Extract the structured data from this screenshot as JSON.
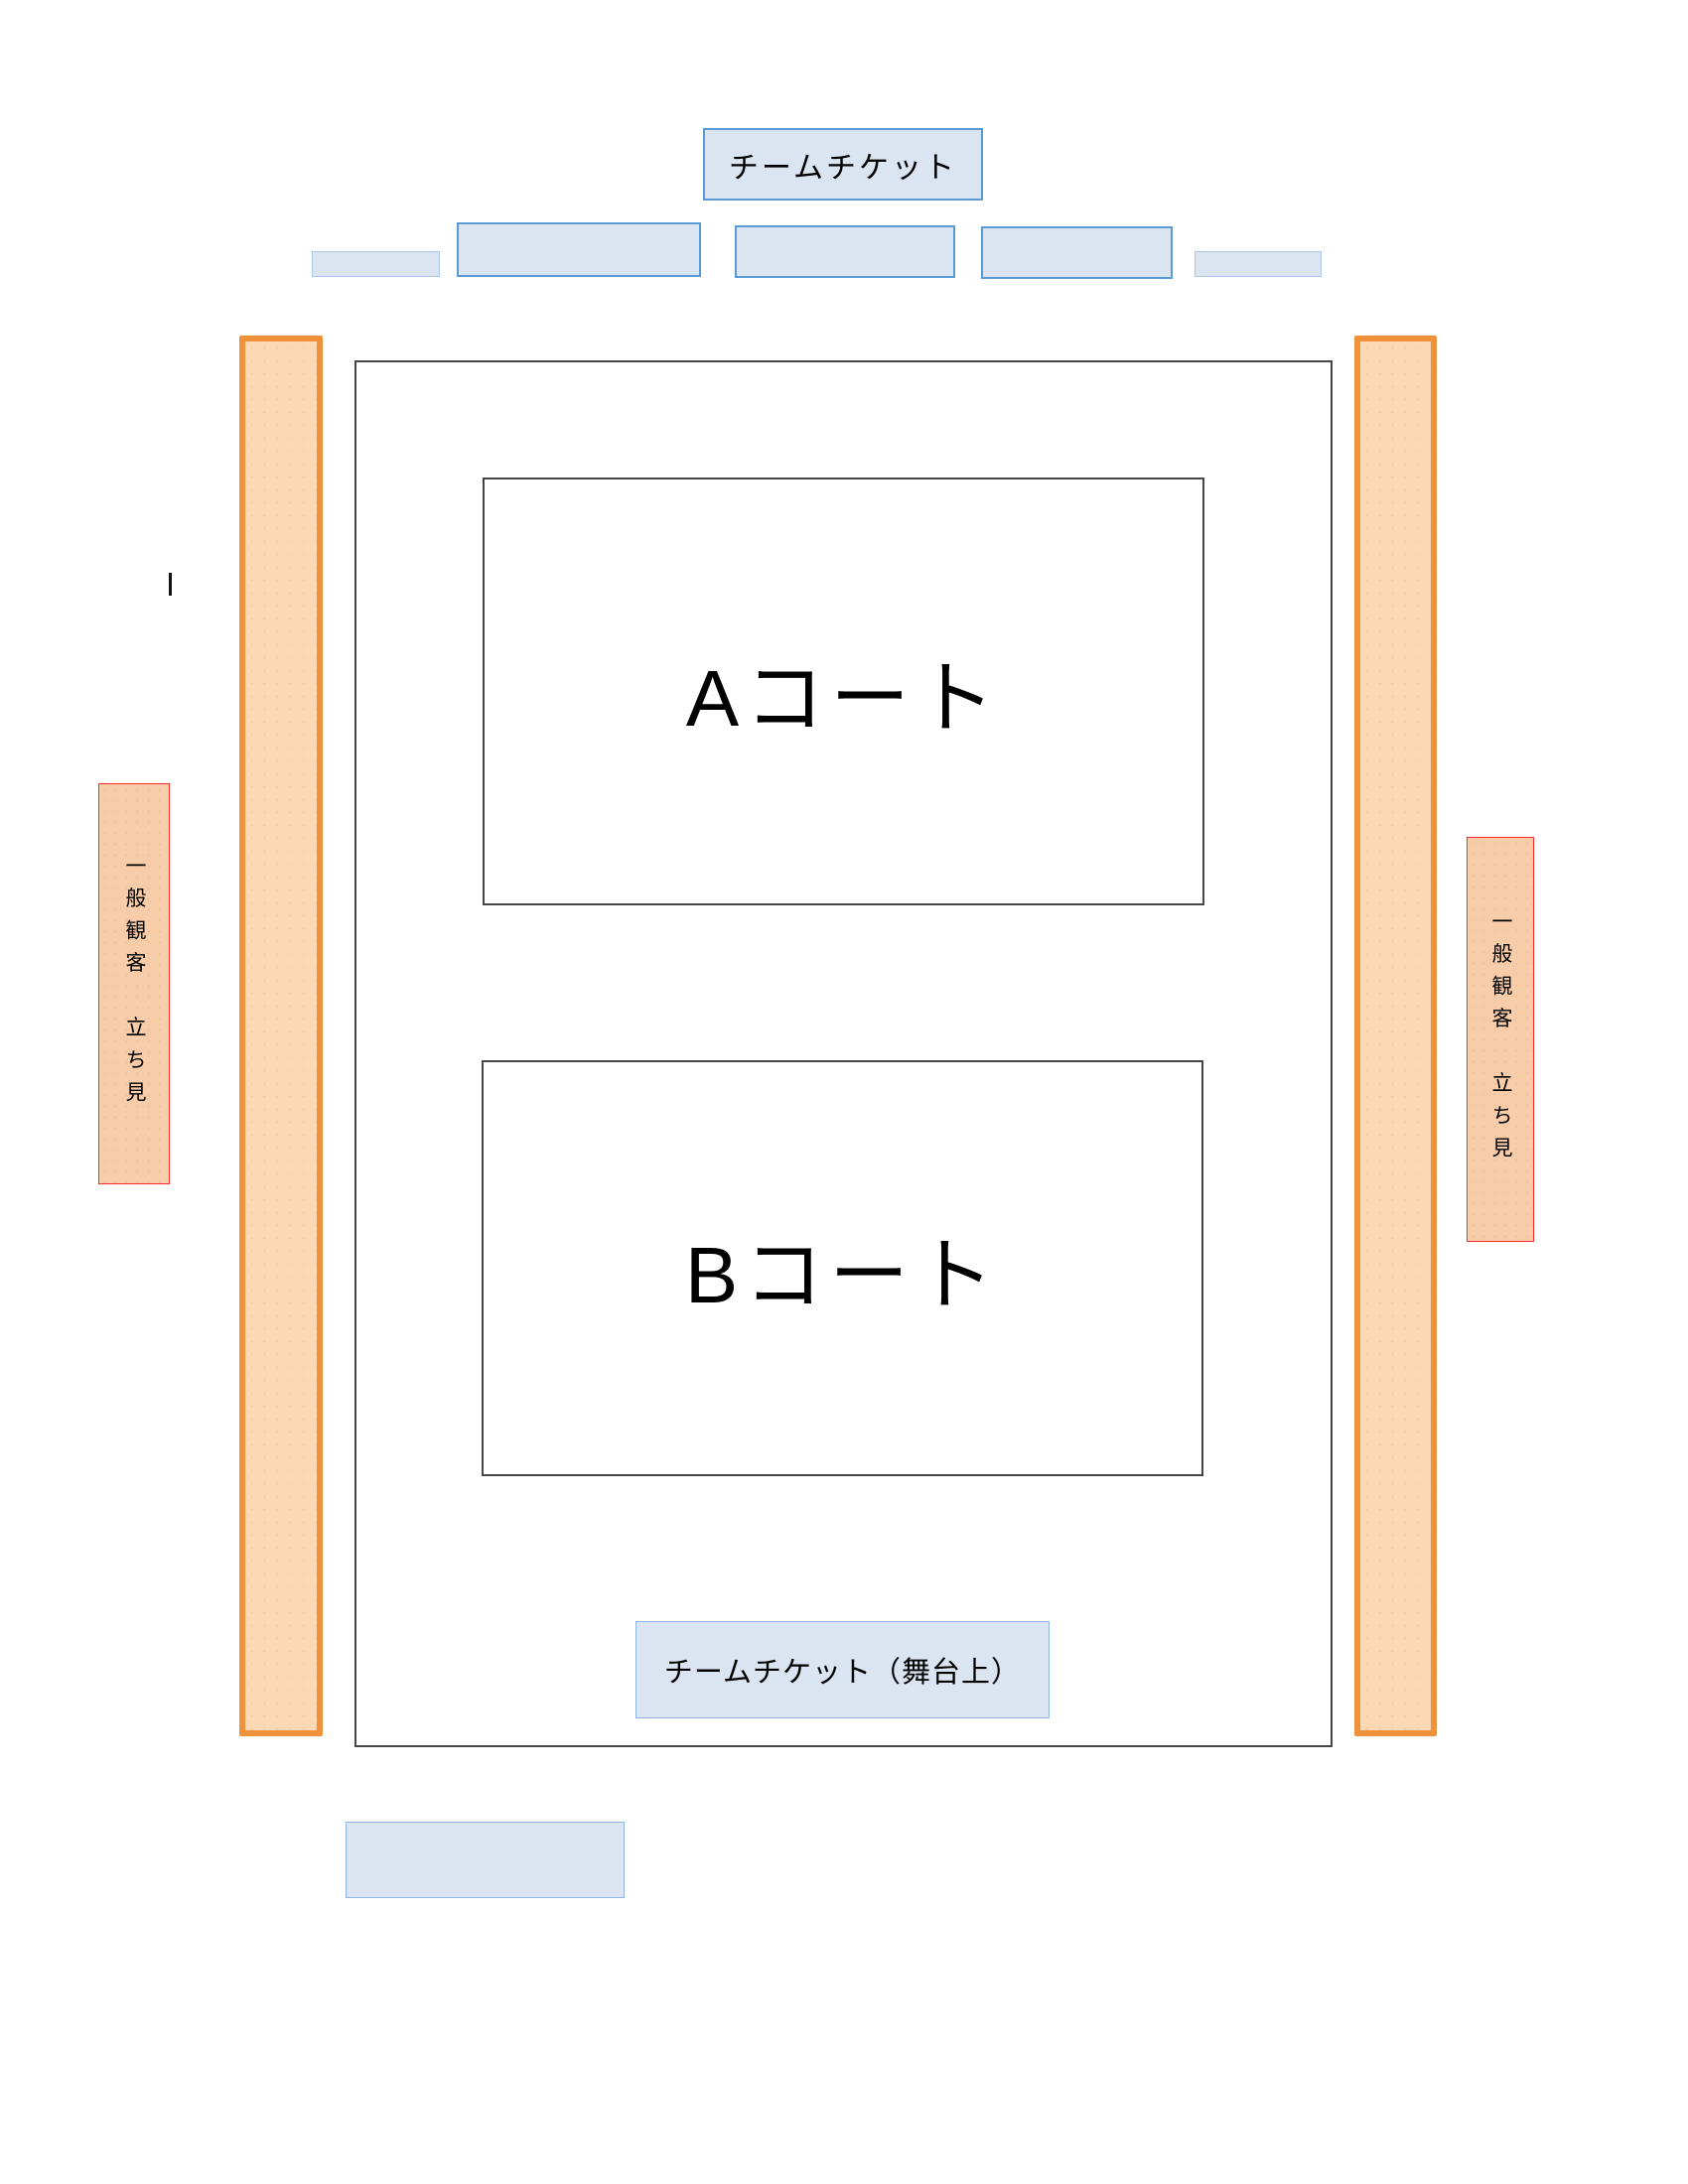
{
  "colors": {
    "page_bg": "#ffffff",
    "text": "#000000",
    "blue_fill": "#dbe5f1",
    "blue_border_strong": "#5b9bd5",
    "blue_border_mid": "#8eb4e3",
    "blue_border_light": "#a9c7e8",
    "orange_fill": "#fcd8b4",
    "orange_border": "#f0923c",
    "peach_fill": "#f7cca9",
    "red_border": "#ff2a2a",
    "dark_border": "#474747"
  },
  "top_ticket_box": {
    "label": "チームチケット"
  },
  "stage_ticket_box": {
    "label": "チームチケット（舞台上）"
  },
  "courts": {
    "a": {
      "label": "Aコート"
    },
    "b": {
      "label": "Bコート"
    }
  },
  "standing_labels": {
    "left": {
      "text": "一般観客　立ち見"
    },
    "right": {
      "text": "一般観客　立ち見"
    }
  }
}
